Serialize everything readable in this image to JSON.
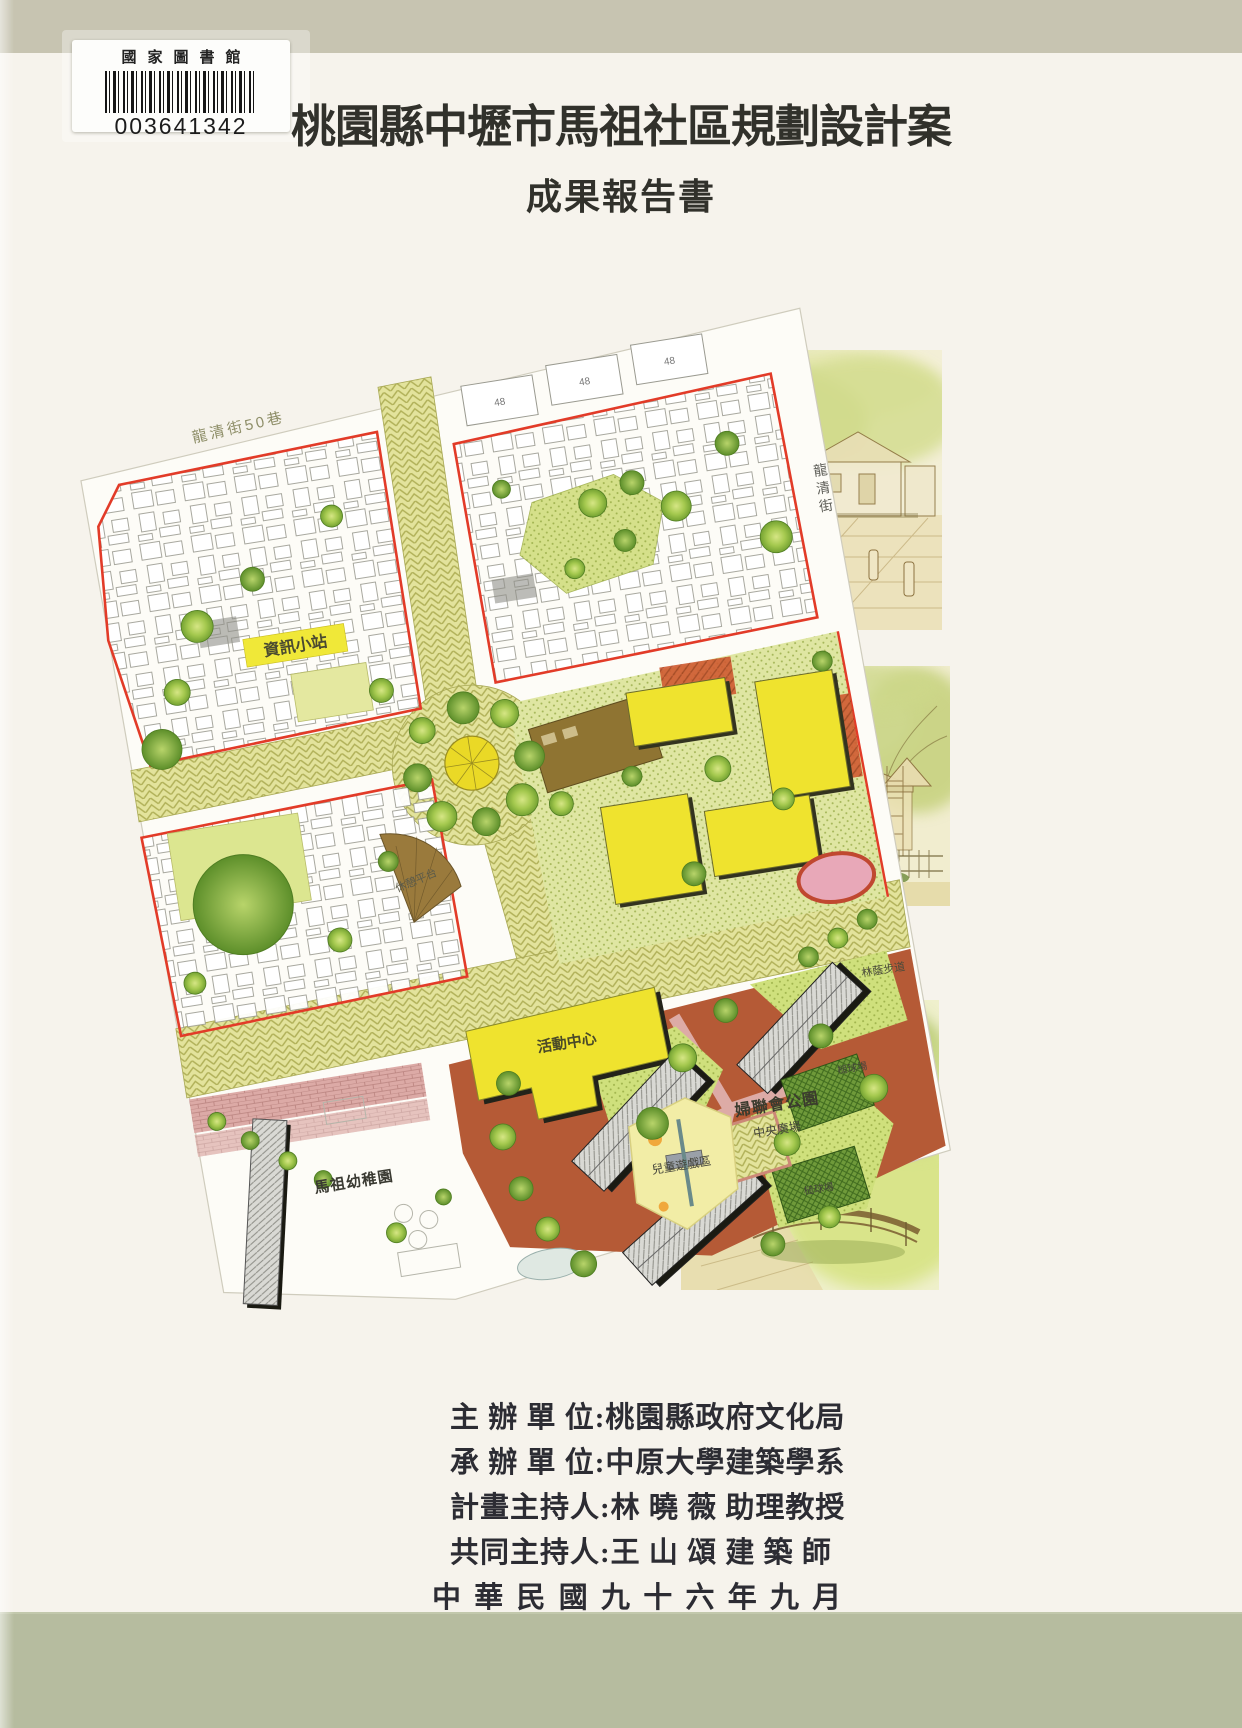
{
  "colors": {
    "top_band": "#c7c4b1",
    "bottom_band": "#b6bc9f",
    "paper": "#f6f3ec",
    "title_ink": "#31312b",
    "boundary_red": "#e23b28",
    "street_khaki": "#e3e39c",
    "building_yellow": "#efe22e",
    "park_terracotta": "#b55a36",
    "brick_pink": "#dcaaa6"
  },
  "library_label": {
    "institution": "國家圖書館",
    "barcode_number": "003641342"
  },
  "title": "桃園縣中壢市馬祖社區規劃設計案",
  "subtitle": "成果報告書",
  "map": {
    "street_label_top": "龍清街50巷",
    "street_right_chars": [
      "龍",
      "清",
      "街"
    ],
    "labels": {
      "info_station": "資訊小站",
      "rest_platform": "休憩平台",
      "activity_center": "活動中心",
      "tree_walk": "林蔭步道",
      "park_name": "婦聯會公園",
      "central_plaza": "中央廣場",
      "children_play": "兒童遊戲區",
      "croquet_1": "槌球場",
      "croquet_2": "槌球場",
      "kindergarten": "馬祖幼稚園",
      "lot_number": "48"
    }
  },
  "credits": {
    "lines": [
      "主 辦 單 位:桃園縣政府文化局",
      "承 辦 單 位:中原大學建築學系",
      "計畫主持人:林 曉 薇 助理教授",
      "共同主持人:王 山 頌 建 築 師"
    ],
    "date_line": "中 華 民 國 九 十 六 年 九 月"
  }
}
